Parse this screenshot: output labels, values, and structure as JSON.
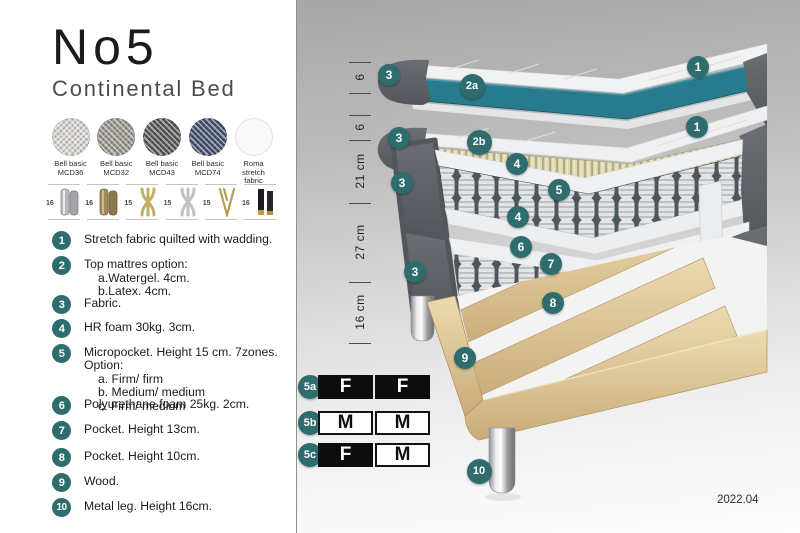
{
  "header": {
    "title": "No5",
    "subtitle": "Continental Bed"
  },
  "fabrics": [
    {
      "line1": "Bell basic",
      "line2": "MCD36",
      "color": "#d9d6cf",
      "woven": true
    },
    {
      "line1": "Bell basic",
      "line2": "MCD32",
      "color": "#9b978f",
      "woven": true
    },
    {
      "line1": "Bell basic",
      "line2": "MCD43",
      "color": "#595b59",
      "woven": true
    },
    {
      "line1": "Bell basic",
      "line2": "MCD74",
      "color": "#49536f",
      "woven": true
    },
    {
      "line1": "Roma",
      "line2": "stretch fabric",
      "color": "#fafafa",
      "woven": false
    }
  ],
  "legs": [
    {
      "height": "16",
      "type": "cylinder-silver"
    },
    {
      "height": "16",
      "type": "cylinder-bronze"
    },
    {
      "height": "15",
      "type": "twisted-gold"
    },
    {
      "height": "15",
      "type": "twisted-silver"
    },
    {
      "height": "15",
      "type": "hairpin-gold"
    },
    {
      "height": "16",
      "type": "block-black-gold"
    }
  ],
  "legend": [
    {
      "num": "1",
      "text": "Stretch fabric quilted with wadding.",
      "subs": []
    },
    {
      "num": "2",
      "text": "Top mattres option:",
      "subs": [
        "a.Watergel. 4cm.",
        "b.Latex. 4cm."
      ]
    },
    {
      "num": "3",
      "text": "Fabric.",
      "subs": []
    },
    {
      "num": "4",
      "text": "HR foam 30kg. 3cm.",
      "subs": []
    },
    {
      "num": "5",
      "text": "Micropocket. Height 15 cm. 7zones. Option:",
      "subs": [
        "a. Firm/ firm",
        "b. Medium/ medium",
        "c. Firm/ medium"
      ]
    },
    {
      "num": "6",
      "text": "Polyurethane foam 25kg. 2cm.",
      "subs": []
    },
    {
      "num": "7",
      "text": "Pocket. Height 13cm.",
      "subs": []
    },
    {
      "num": "8",
      "text": "Pocket. Height 10cm.",
      "subs": []
    },
    {
      "num": "9",
      "text": "Wood.",
      "subs": []
    },
    {
      "num": "10",
      "text": "Metal leg. Height 16cm.",
      "subs": []
    }
  ],
  "diagram": {
    "ruler_labels": [
      "6",
      "6",
      "21 cm",
      "27 cm",
      "16 cm"
    ],
    "badges": [
      "3",
      "2a",
      "1",
      "3",
      "2b",
      "1",
      "4",
      "3",
      "5",
      "4",
      "6",
      "7",
      "3",
      "8",
      "9",
      "10"
    ]
  },
  "firmness_table": {
    "rows": [
      {
        "label": "5a",
        "cells": [
          {
            "text": "F",
            "variant": "dark"
          },
          {
            "text": "F",
            "variant": "dark"
          }
        ]
      },
      {
        "label": "5b",
        "cells": [
          {
            "text": "M",
            "variant": "light"
          },
          {
            "text": "M",
            "variant": "light"
          }
        ]
      },
      {
        "label": "5c",
        "cells": [
          {
            "text": "F",
            "variant": "dark"
          },
          {
            "text": "M",
            "variant": "light"
          }
        ]
      }
    ]
  },
  "version": "2022.04",
  "colors": {
    "badge_teal": "#2e6c6e",
    "mattress_teal": "#277b8c",
    "dark_fabric": "#5c6065",
    "latex_beige": "#ded8b2",
    "wood": "#e2c99c",
    "table_dark": "#0d0d0d"
  }
}
